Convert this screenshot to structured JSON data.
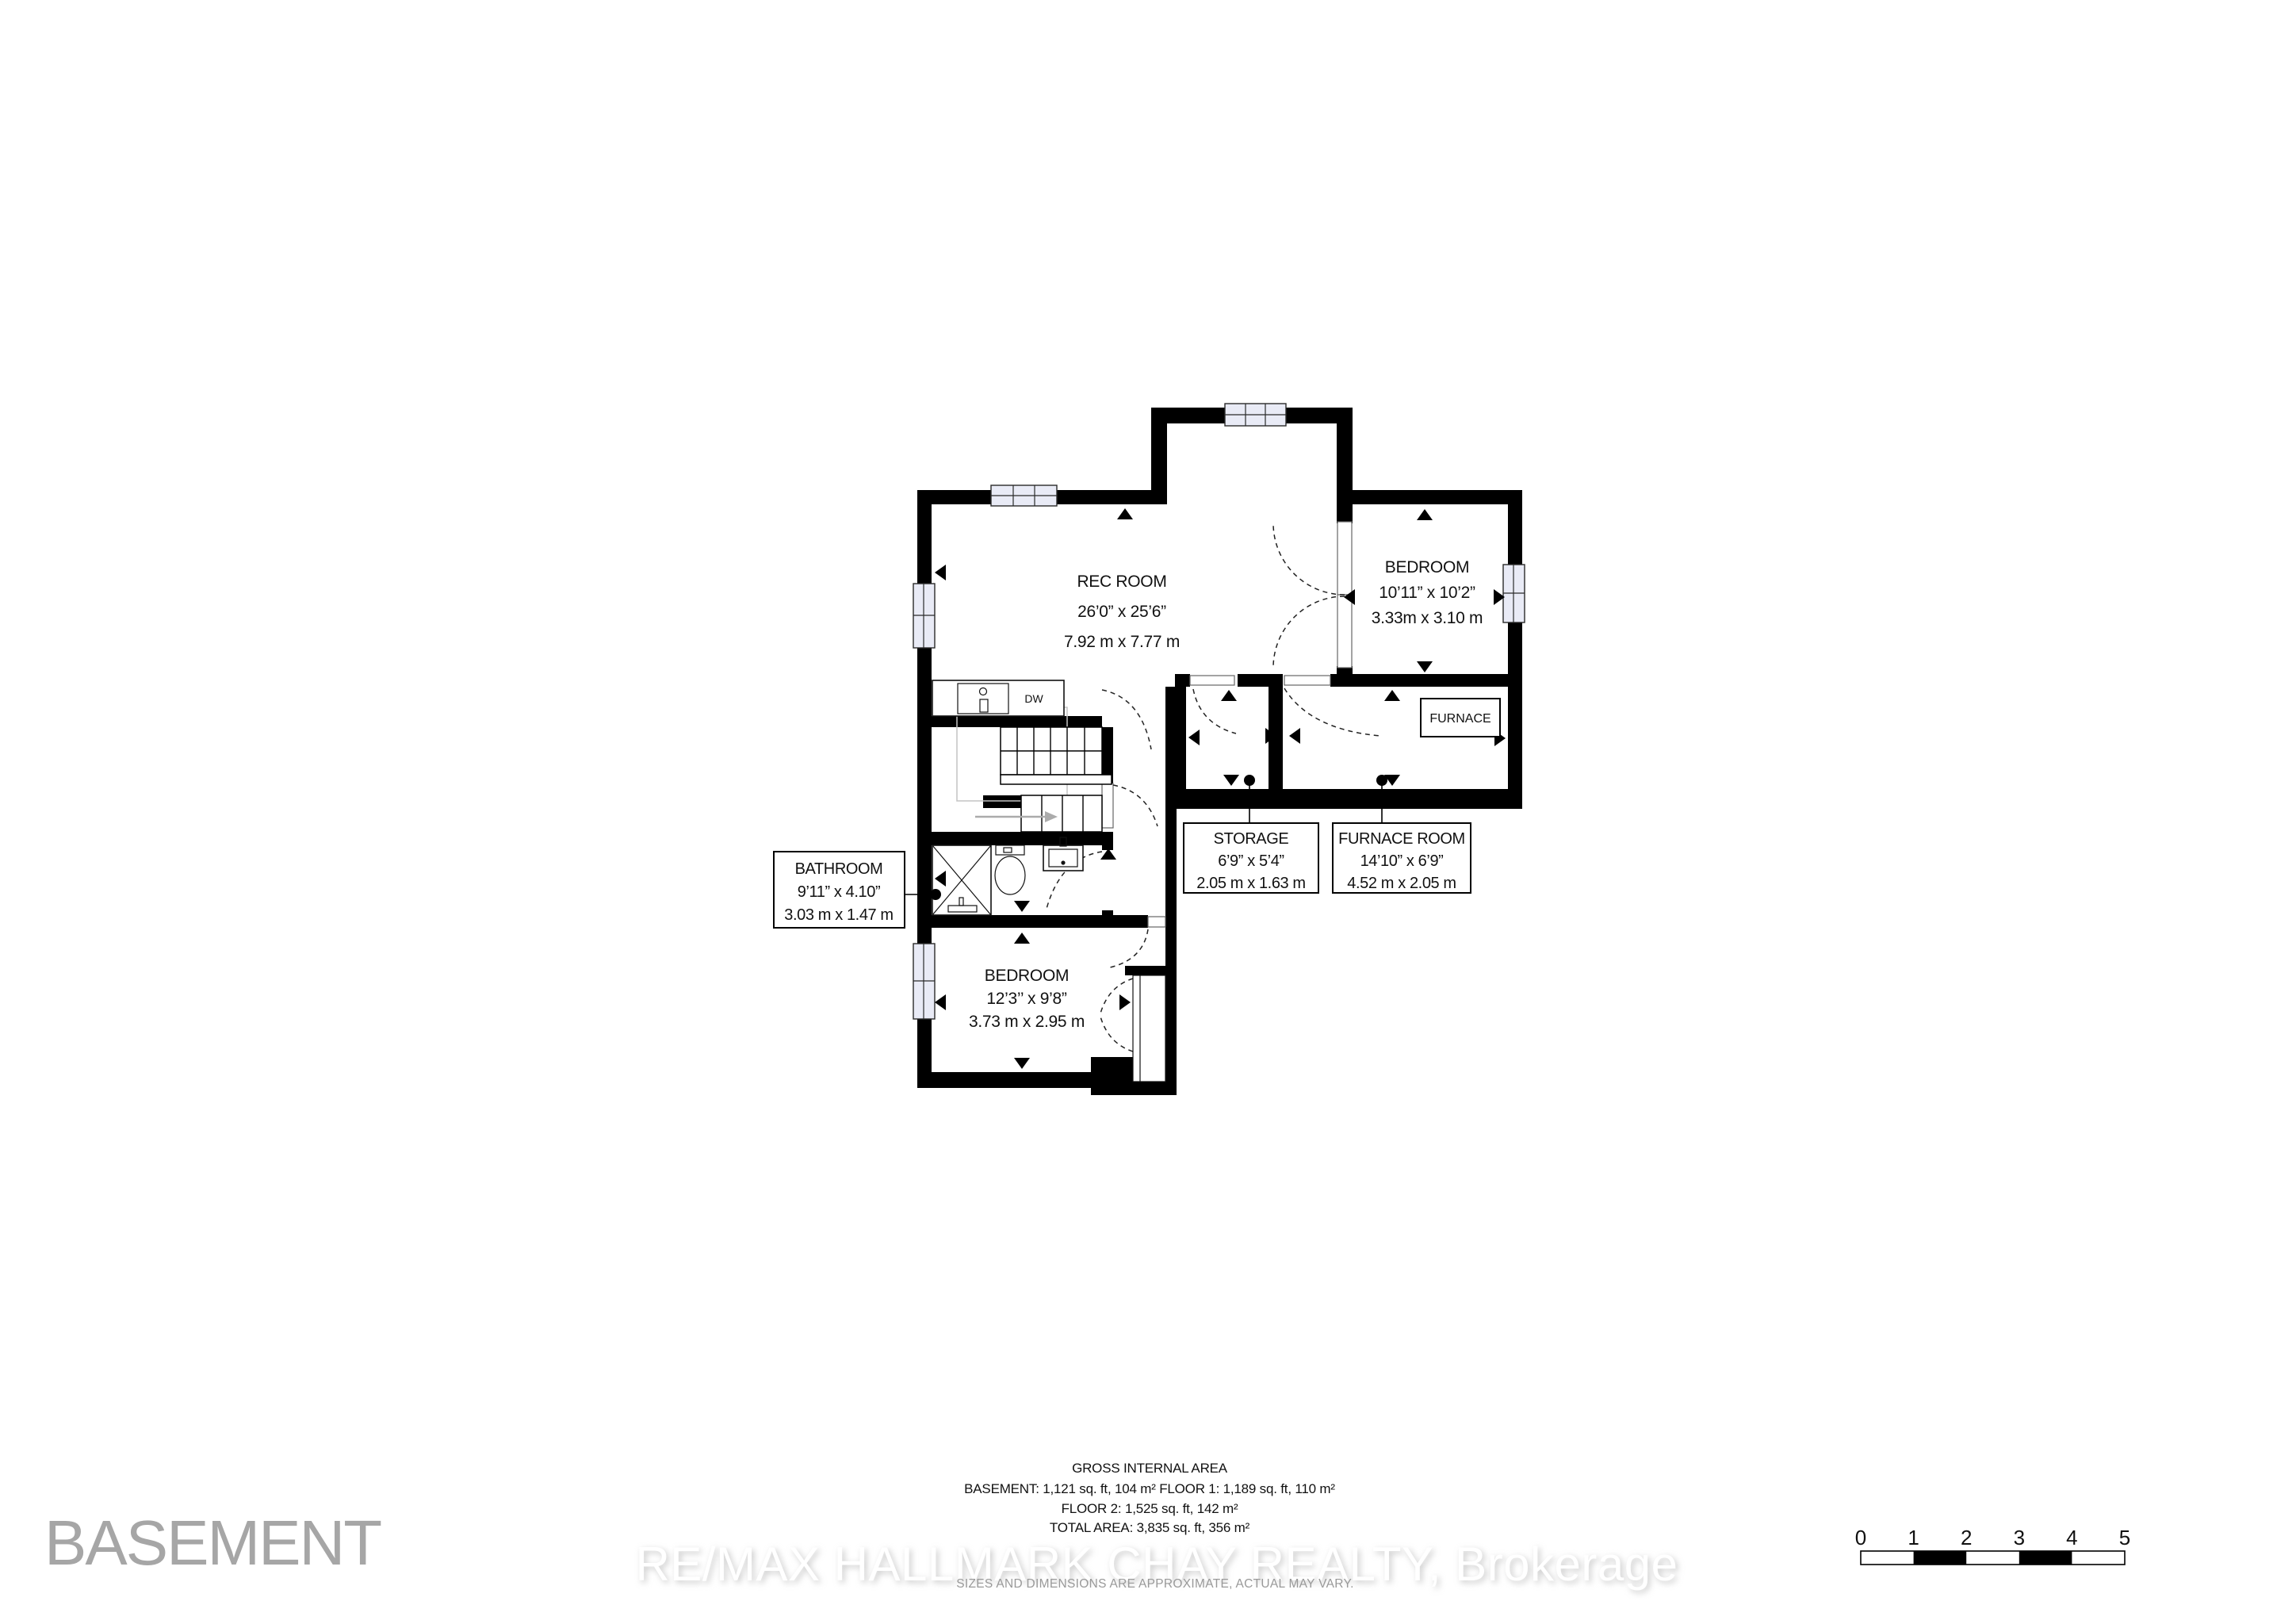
{
  "floor_title": "BASEMENT",
  "plan": {
    "rooms": {
      "rec_room": {
        "label": "REC ROOM",
        "dim_imperial": "26’0” x 25’6”",
        "dim_metric": "7.92 m x 7.77 m"
      },
      "bedroom_upper": {
        "label": "BEDROOM",
        "dim_imperial": "10’11” x 10’2”",
        "dim_metric": "3.33m x 3.10  m"
      },
      "storage": {
        "label": "STORAGE",
        "dim_imperial": "6’9” x 5’4”",
        "dim_metric": "2.05 m x 1.63 m"
      },
      "furnace_room": {
        "label": "FURNACE ROOM",
        "dim_imperial": "14’10” x 6’9”",
        "dim_metric": "4.52 m x 2.05 m"
      },
      "bathroom": {
        "label": "BATHROOM",
        "dim_imperial": "9’11” x 4.10”",
        "dim_metric": "3.03 m x 1.47 m"
      },
      "bedroom_lower": {
        "label": "BEDROOM",
        "dim_imperial": "12’3’’ x 9’8”",
        "dim_metric": "3.73 m x 2.95 m"
      }
    },
    "fixtures": {
      "furnace_label": "FURNACE",
      "dishwasher_label": "DW"
    }
  },
  "area_summary": {
    "heading": "GROSS INTERNAL AREA",
    "line_basement_floor1": "BASEMENT: 1,121 sq. ft, 104 m² FLOOR 1: 1,189 sq. ft, 110 m²",
    "line_floor2": "FLOOR 2: 1,525 sq. ft, 142 m²",
    "line_total": "TOTAL AREA: 3,835 sq. ft, 356 m²"
  },
  "branding": {
    "watermark": "RE/MAX HALLMARK CHAY REALTY, Brokerage"
  },
  "disclaimer": "SIZES AND DIMENSIONS ARE APPROXIMATE, ACTUAL MAY VARY.",
  "scale_bar": {
    "ticks": [
      "0",
      "1",
      "2",
      "3",
      "4",
      "5"
    ]
  },
  "colors": {
    "wall": "#000000",
    "window_fill": "#e9ebf6",
    "muted_text": "#a6a6a6",
    "disclaimer_text": "#999999",
    "watermark_text": "#ffffff"
  }
}
